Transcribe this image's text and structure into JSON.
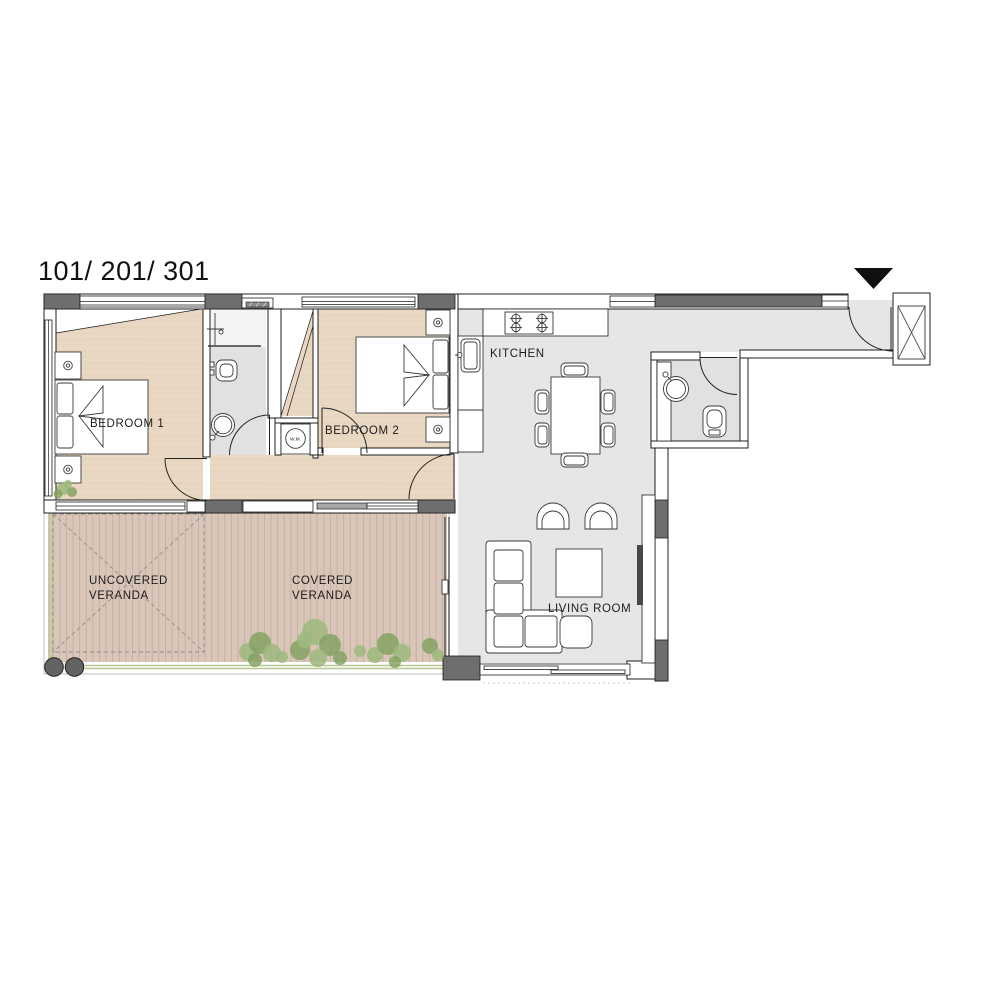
{
  "title": "101/ 201/ 301",
  "labels": {
    "bedroom1": "BEDROOM 1",
    "bedroom2": "BEDROOM 2",
    "kitchen": "KITCHEN",
    "living_room": "LIVING ROOM",
    "uncovered_line1": "UNCOVERED",
    "uncovered_line2": "VERANDA",
    "covered_line1": "COVERED",
    "covered_line2": "VERANDA",
    "washing_machine": "W.M."
  },
  "colors": {
    "outline": "#1f1f1f",
    "wall_dark": "#6e6e6e",
    "wood_floor": "#e9d8c3",
    "wood_grain": "#d9c2a6",
    "deck": "#d9c6b8",
    "deck_line": "#b9a695",
    "floor_gray": "#e6e6e6",
    "bath_gray": "#e1e1e1",
    "plant_green": "#9cb87c",
    "plant_green_dark": "#7fa05e",
    "edge_green": "#b7c693",
    "column_gray": "#636363"
  }
}
